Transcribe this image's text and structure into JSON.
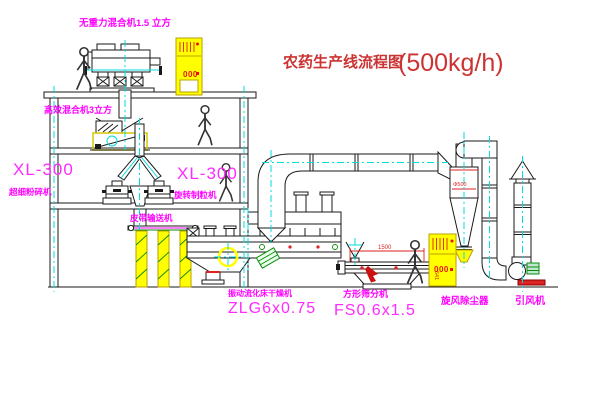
{
  "diagram": {
    "title": "农药生产线流程图",
    "capacity": "(500kg/h)"
  },
  "equipment_labels": {
    "gravity_mixer": "无重力混合机1.5 立方",
    "high_eff_mixer": "高效混合机3立方",
    "mill_model": "XL-300",
    "mill_name": "超细粉碎机",
    "granulator_model": "XL-300",
    "granulator_name": "旋转制粒机",
    "belt_conveyor": "皮带输送机",
    "dryer_name": "振动流化床干燥机",
    "dryer_model": "ZLG6x0.75",
    "sieve_name": "方形筛分机",
    "sieve_model": "FS0.6x1.5",
    "cyclone_name": "旋风除尘器",
    "fan_name": "引风机"
  },
  "dimensions": {
    "sieve_length": "1500",
    "sieve_height": "541",
    "cyclone_inlet": "Φ500"
  },
  "control_panels": {
    "panel_top": "000",
    "panel_ground": "000"
  },
  "colors": {
    "label_magenta": "#ff00ff",
    "title_red": "#cc3333",
    "line_black": "#1a1a1a",
    "highlight_yellow": "#ffff00",
    "centerline_cyan": "#00dcdc",
    "dimension_red": "#dd2222",
    "accent_green": "#0a8a0a"
  }
}
